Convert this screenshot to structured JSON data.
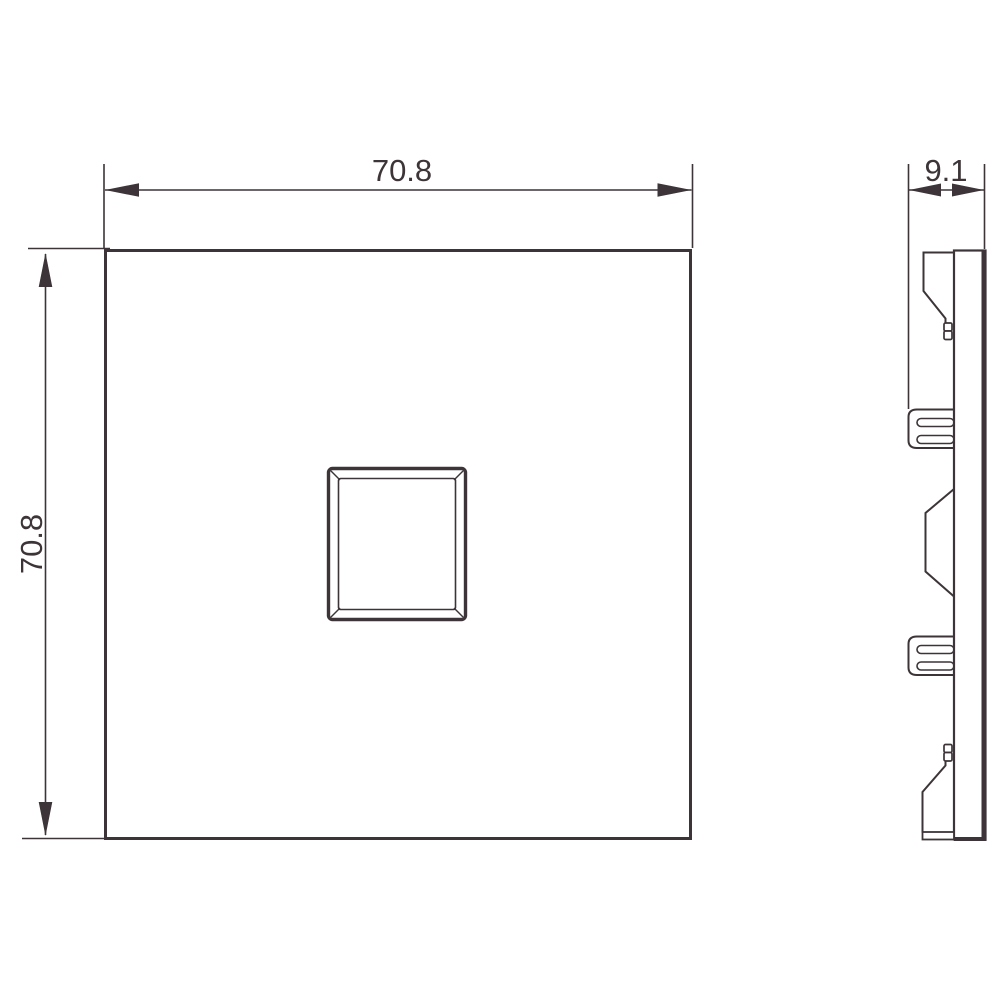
{
  "colors": {
    "background": "#ffffff",
    "line": "#3c3438"
  },
  "dimensions": {
    "front_width": "70.8",
    "front_height": "70.8",
    "side_depth": "9.1"
  }
}
